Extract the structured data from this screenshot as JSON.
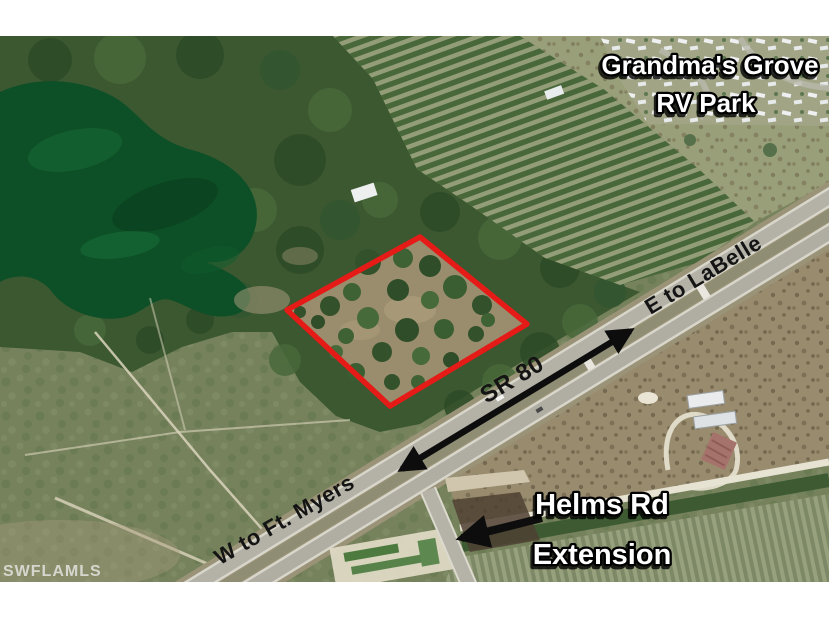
{
  "annotations": {
    "rv_park": {
      "line1": "Grandma's Grove",
      "line2": "RV Park"
    },
    "direction_east": "E to LaBelle",
    "highway_name": "SR 80",
    "direction_west": "W to Ft. Myers",
    "helms": {
      "line1": "Helms Rd",
      "line2": "Extension"
    },
    "watermark": "SWFLAMLS"
  },
  "colors": {
    "parcel_outline": "#e41b17",
    "arrow_black": "#0d0d0d",
    "label_black": "#141414",
    "label_white": "#ffffff",
    "watermark": "#e9e9e6",
    "frame_white": "#ffffff",
    "lake_green": "#0d4f26",
    "forest_green": "#3b5831",
    "scrub_green": "#76825c",
    "field_tan": "#998b6e",
    "road_gray": "#b3b0a6"
  }
}
